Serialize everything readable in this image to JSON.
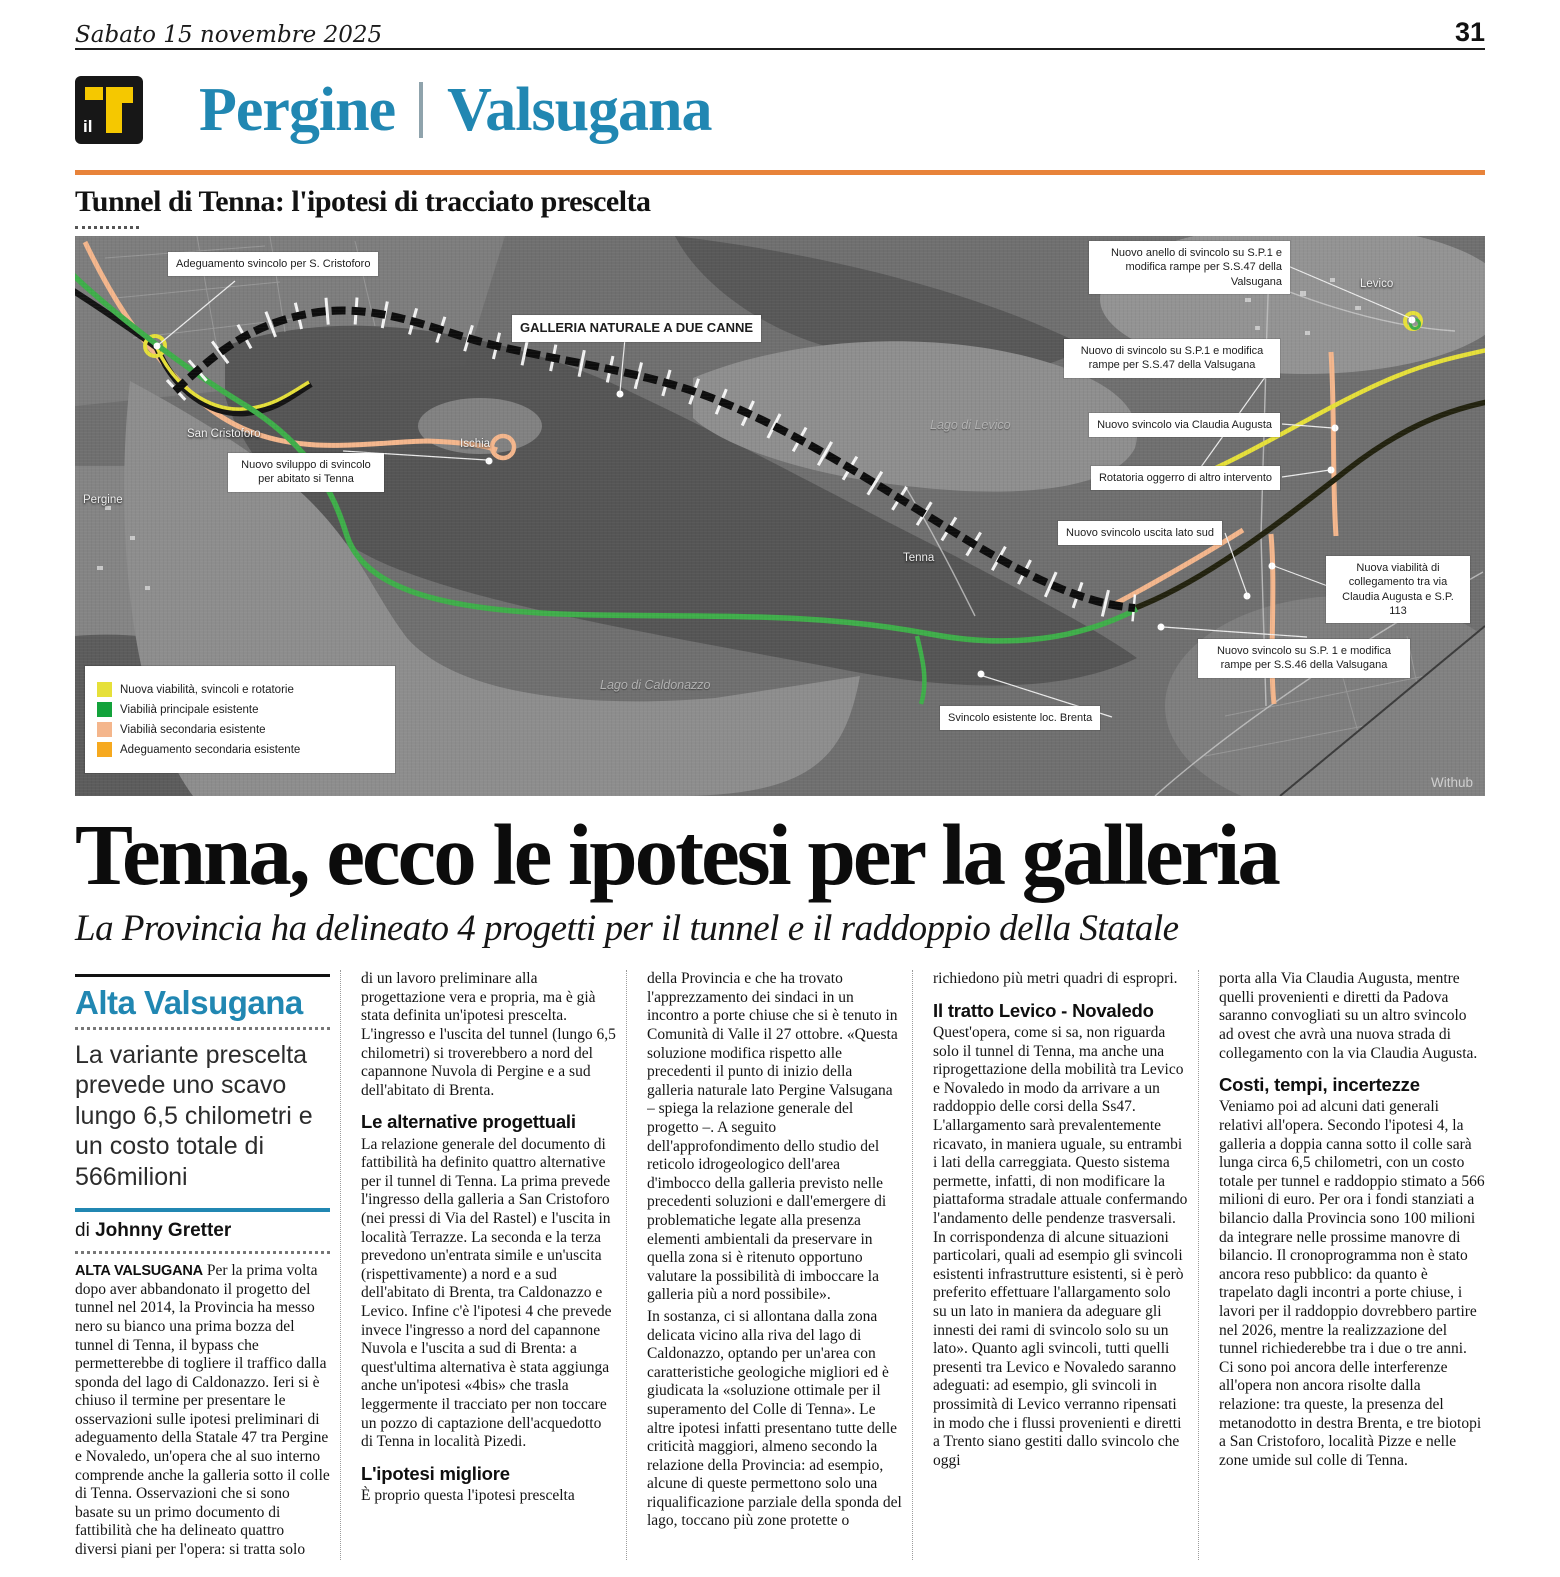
{
  "page": {
    "date": "Sabato 15 novembre 2025",
    "number": "31"
  },
  "colors": {
    "accent_blue": "#2187b2",
    "rule_orange": "#e8833a",
    "logo_yellow": "#f5c800",
    "legend_yellow": "#e6e03a",
    "legend_green": "#13a23b",
    "legend_peach": "#f4b68c",
    "legend_orange": "#f6a91f"
  },
  "masthead": {
    "logo_small": "il",
    "section_left": "Pergine",
    "section_right": "Valsugana"
  },
  "kicker": "Tunnel di Tenna: l'ipotesi di tracciato prescelta",
  "map": {
    "callouts": {
      "adeguamento": "Adeguamento svincolo per S. Cristoforo",
      "galleria": "GALLERIA NATURALE A DUE CANNE",
      "anello": "Nuovo anello di svincolo su S.P.1 e modifica rampe per S.S.47 della Valsugana",
      "nuovo_sp1_ss47": "Nuovo di svincolo su S.P.1 e modifica rampe per S.S.47 della Valsugana",
      "claudia_augusta": "Nuovo svincolo via Claudia Augusta",
      "rotatoria": "Rotatoria oggerro di altro intervento",
      "uscita_sud": "Nuovo svincolo uscita lato sud",
      "viabilita_collegamento": "Nuova viabilità di collegamento tra via Claudia Augusta e S.P. 113",
      "nuovo_sp1_ss46": "Nuovo svincolo su S.P. 1 e modifica rampe per S.S.46 della Valsugana",
      "brenta": "Svincolo esistente loc. Brenta",
      "sviluppo_tenna": "Nuovo sviluppo di svincolo per abitato si Tenna"
    },
    "places": {
      "pergine": "Pergine",
      "san_cristoforo": "San Cristoforo",
      "ischia": "Ischia",
      "tenna": "Tenna",
      "levico": "Levico",
      "lago_levico": "Lago di Levico",
      "lago_caldonazzo": "Lago di Caldonazzo",
      "watermark": "Withub"
    },
    "legend": [
      {
        "color": "#e6e03a",
        "label": "Nuova viabilità, svincoli e rotatorie"
      },
      {
        "color": "#13a23b",
        "label": "Viabilià principale esistente"
      },
      {
        "color": "#f4b68c",
        "label": "Viabilià secondaria esistente"
      },
      {
        "color": "#f6a91f",
        "label": "Adeguamento secondaria esistente"
      }
    ]
  },
  "headline": "Tenna, ecco le ipotesi per la galleria",
  "subheadline": "La Provincia ha delineato 4 progetti per il tunnel e il raddoppio della Statale",
  "sidebar": {
    "section": "Alta Valsugana",
    "standfirst": "La variante prescelta prevede uno scavo lungo 6,5 chilometri e un costo totale di 566milioni",
    "byline_prefix": "di ",
    "byline_name": "Johnny Gretter",
    "lead_label": "ALTA VALSUGANA",
    "lead_text": " Per la prima volta dopo aver abbandonato il progetto del tunnel nel 2014, la Provincia ha messo nero su bianco una prima bozza del tunnel di Tenna, il bypass che permetterebbe di togliere il traffico dalla sponda del lago di Caldonazzo. Ieri si è chiuso il termine per presentare le osservazioni sulle ipotesi preliminari di adeguamento della Statale 47 tra Pergine e Novaledo, un'opera che al suo interno comprende anche la galleria sotto il colle di Tenna. Osservazioni che si sono basate su un primo documento di fattibilità che ha delineato quattro diversi piani per l'opera: si tratta solo"
  },
  "article": {
    "col2": [
      {
        "type": "p",
        "text": "di un lavoro preliminare alla progettazione vera e propria, ma è già stata definita un'ipotesi prescelta. L'ingresso e l'uscita del tunnel (lungo 6,5 chilometri) si troverebbero a nord del capannone Nuvola di Pergine e a sud dell'abitato di Brenta."
      },
      {
        "type": "h",
        "text": "Le alternative progettuali"
      },
      {
        "type": "p",
        "text": "La relazione generale del documento di fattibilità ha definito quattro alternative per il tunnel di Tenna. La prima prevede l'ingresso della galleria a San Cristoforo (nei pressi di Via del Rastel) e l'uscita in località Terrazze. La seconda e la terza prevedono un'entrata simile e un'uscita (rispettivamente) a nord e a sud dell'abitato di Brenta, tra Caldonazzo e Levico. Infine c'è l'ipotesi 4 che prevede invece l'ingresso a nord del capannone Nuvola e l'uscita a sud di Brenta: a quest'ultima alternativa è stata aggiunga anche un'ipotesi «4bis» che trasla leggermente il tracciato per non toccare un pozzo di captazione dell'acquedotto di Tenna in località Pizedi."
      },
      {
        "type": "h",
        "text": "L'ipotesi migliore"
      },
      {
        "type": "p",
        "text": "È proprio questa l'ipotesi prescelta"
      }
    ],
    "col3": [
      {
        "type": "p",
        "text": "della Provincia e che ha trovato l'apprezzamento dei sindaci in un incontro a porte chiuse che si è tenuto in Comunità di Valle il 27 ottobre. «Questa soluzione modifica rispetto alle precedenti il punto di inizio della galleria naturale lato Pergine Valsugana – spiega la relazione generale del progetto –. A seguito dell'approfondimento dello studio del reticolo idrogeologico dell'area d'imbocco della galleria previsto nelle precedenti soluzioni e dall'emergere di problematiche legate alla presenza elementi ambientali da preservare in quella zona si è ritenuto opportuno valutare la possibilità di imboccare la galleria più a nord possibile»."
      },
      {
        "type": "p",
        "text": "In sostanza, ci si allontana dalla zona delicata vicino alla riva del lago di Caldonazzo, optando per un'area con caratteristiche geologiche migliori ed è giudicata la «soluzione ottimale per il superamento del Colle di Tenna». Le altre ipotesi infatti presentano tutte delle criticità maggiori, almeno secondo la relazione della Provincia: ad esempio, alcune di queste permettono solo una riqualificazione parziale della sponda del lago, toccano più zone protette o"
      }
    ],
    "col4": [
      {
        "type": "p",
        "text": "richiedono più metri quadri di espropri."
      },
      {
        "type": "h",
        "text": "Il tratto Levico - Novaledo"
      },
      {
        "type": "p",
        "text": "Quest'opera, come si sa, non riguarda solo il tunnel di Tenna, ma anche una riprogettazione della mobilità tra Levico e Novaledo in modo da arrivare a un raddoppio delle corsi della Ss47. L'allargamento sarà prevalentemente ricavato, in maniera uguale, su entrambi i lati della carreggiata. Questo sistema permette, infatti, di non modificare la piattaforma stradale attuale confermando l'andamento delle pendenze trasversali. In corrispondenza di alcune situazioni particolari, quali ad esempio gli svincoli esistenti infrastrutture esistenti, si è però preferito effettuare l'allargamento solo su un lato in maniera da adeguare gli innesti dei rami di svincolo solo su un lato». Quanto agli svincoli, tutti quelli presenti tra Levico e Novaledo saranno adeguati: ad esempio, gli svincoli in prossimità di Levico verranno ripensati in modo che i flussi provenienti e diretti a Trento siano gestiti dallo svincolo che oggi"
      }
    ],
    "col5": [
      {
        "type": "p",
        "text": "porta alla Via Claudia Augusta, mentre quelli provenienti e diretti da Padova saranno convogliati su un altro svincolo ad ovest che avrà una nuova strada di collegamento con la via Claudia Augusta."
      },
      {
        "type": "h",
        "text": "Costi, tempi, incertezze"
      },
      {
        "type": "p",
        "text": "Veniamo poi ad alcuni dati generali relativi all'opera. Secondo l'ipotesi 4, la galleria a doppia canna sotto il colle sarà lunga circa 6,5 chilometri, con un costo totale per tunnel e raddoppio stimato a 566 milioni di euro. Per ora i fondi stanziati a bilancio dalla Provincia sono 100 milioni da integrare nelle prossime manovre di bilancio. Il cronoprogramma non è stato ancora reso pubblico: da quanto è trapelato dagli incontri a porte chiuse, i lavori per il raddoppio dovrebbero partire nel 2026, mentre la realizzazione del tunnel richiederebbe tra i due o tre anni. Ci sono poi ancora delle interferenze all'opera non ancora risolte dalla relazione: tra queste, la presenza del metanodotto in destra Brenta, e tre biotopi a San Cristoforo, località Pizze e nelle zone umide sul colle di Tenna."
      }
    ]
  }
}
